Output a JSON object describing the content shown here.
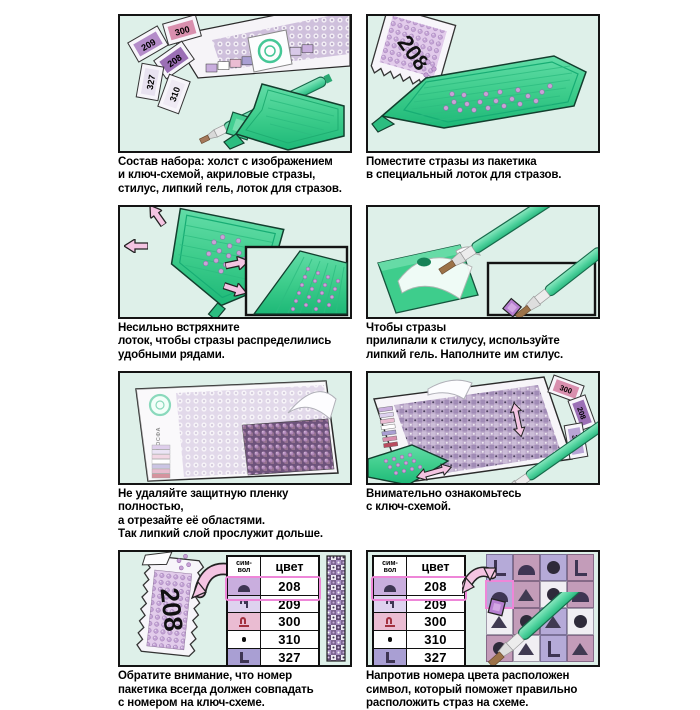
{
  "panels": [
    {
      "caption": "Состав набора: холст с изображением\nи ключ-схемой, акриловые стразы,\nстилус, липкий гель, лоток для стразов."
    },
    {
      "caption": "Поместите стразы из пакетика\nв специальный лоток для стразов.",
      "packet_label": "208"
    },
    {
      "caption": "Несильно встряхните\nлоток, чтобы стразы распределились\nудобными рядами."
    },
    {
      "caption": "Чтобы стразы\nприлипали к стилусу, используйте\nлипкий гель. Наполните им стилус."
    },
    {
      "caption": "Не удаляйте защитную пленку полностью,\nа отрезайте её областями.\nТак липкий слой прослужит дольше.",
      "brand": "МОСФА"
    },
    {
      "caption": "Внимательно ознакомьтесь\nс ключ-схемой."
    },
    {
      "caption": "Обратите внимание, что номер\nпакетика всегда должен совпадать\nс номером на ключ-схеме.",
      "packet_label": "208"
    },
    {
      "caption": "Напротив номера цвета расположен\nсимвол, который поможет правильно\nрасположить страз на схеме."
    }
  ],
  "kit_packets": [
    "209",
    "300",
    "208",
    "327",
    "310"
  ],
  "key_table": {
    "header_symbol": "сим-\nвол",
    "header_color": "цвет",
    "rows": [
      {
        "symbol": "dome",
        "color": "208",
        "bg": "#c9aede",
        "highlight": true
      },
      {
        "symbol": "hook",
        "color": "209",
        "bg": "#ded2ef",
        "highlight": false
      },
      {
        "symbol": "arch",
        "color": "300",
        "bg": "#eabcd2",
        "highlight": false
      },
      {
        "symbol": "dot",
        "color": "310",
        "bg": "#ffffff",
        "highlight": false
      },
      {
        "symbol": "L",
        "color": "327",
        "bg": "#a99fd3",
        "highlight": false
      }
    ]
  },
  "schema_grid": {
    "cells": [
      {
        "symbol": "L",
        "bg": "#b5aad8"
      },
      {
        "symbol": "dome",
        "bg": "#c39cb9"
      },
      {
        "symbol": "circle",
        "bg": "#b5aad8"
      },
      {
        "symbol": "L",
        "bg": "#c39cb9"
      },
      {
        "symbol": "dome",
        "bg": "#b5aad8",
        "highlight": true
      },
      {
        "symbol": "triangle",
        "bg": "#c39cb9"
      },
      {
        "symbol": "circle",
        "bg": "#f0eef3"
      },
      {
        "symbol": "dome",
        "bg": "#c39cb9"
      },
      {
        "symbol": "triangle",
        "bg": "#f0eef3"
      },
      {
        "symbol": "circle",
        "bg": "#c39cb9"
      },
      {
        "symbol": "triangle",
        "bg": "#b5aad8"
      },
      {
        "symbol": "circle",
        "bg": "#f0eef3"
      },
      {
        "symbol": "circle",
        "bg": "#c39cb9"
      },
      {
        "symbol": "triangle",
        "bg": "#f0eef3"
      },
      {
        "symbol": "L",
        "bg": "#b5aad8"
      },
      {
        "symbol": "triangle",
        "bg": "#c39cb9"
      }
    ]
  },
  "colors": {
    "panel_bg": "#def0e9",
    "tray_green": "#3ecd8c",
    "pen_green": "#4fd29e",
    "arrow_pink": "#f4c4e2",
    "highlight_pink": "#ee86d8",
    "stone_purple": "#c9a3d6"
  }
}
